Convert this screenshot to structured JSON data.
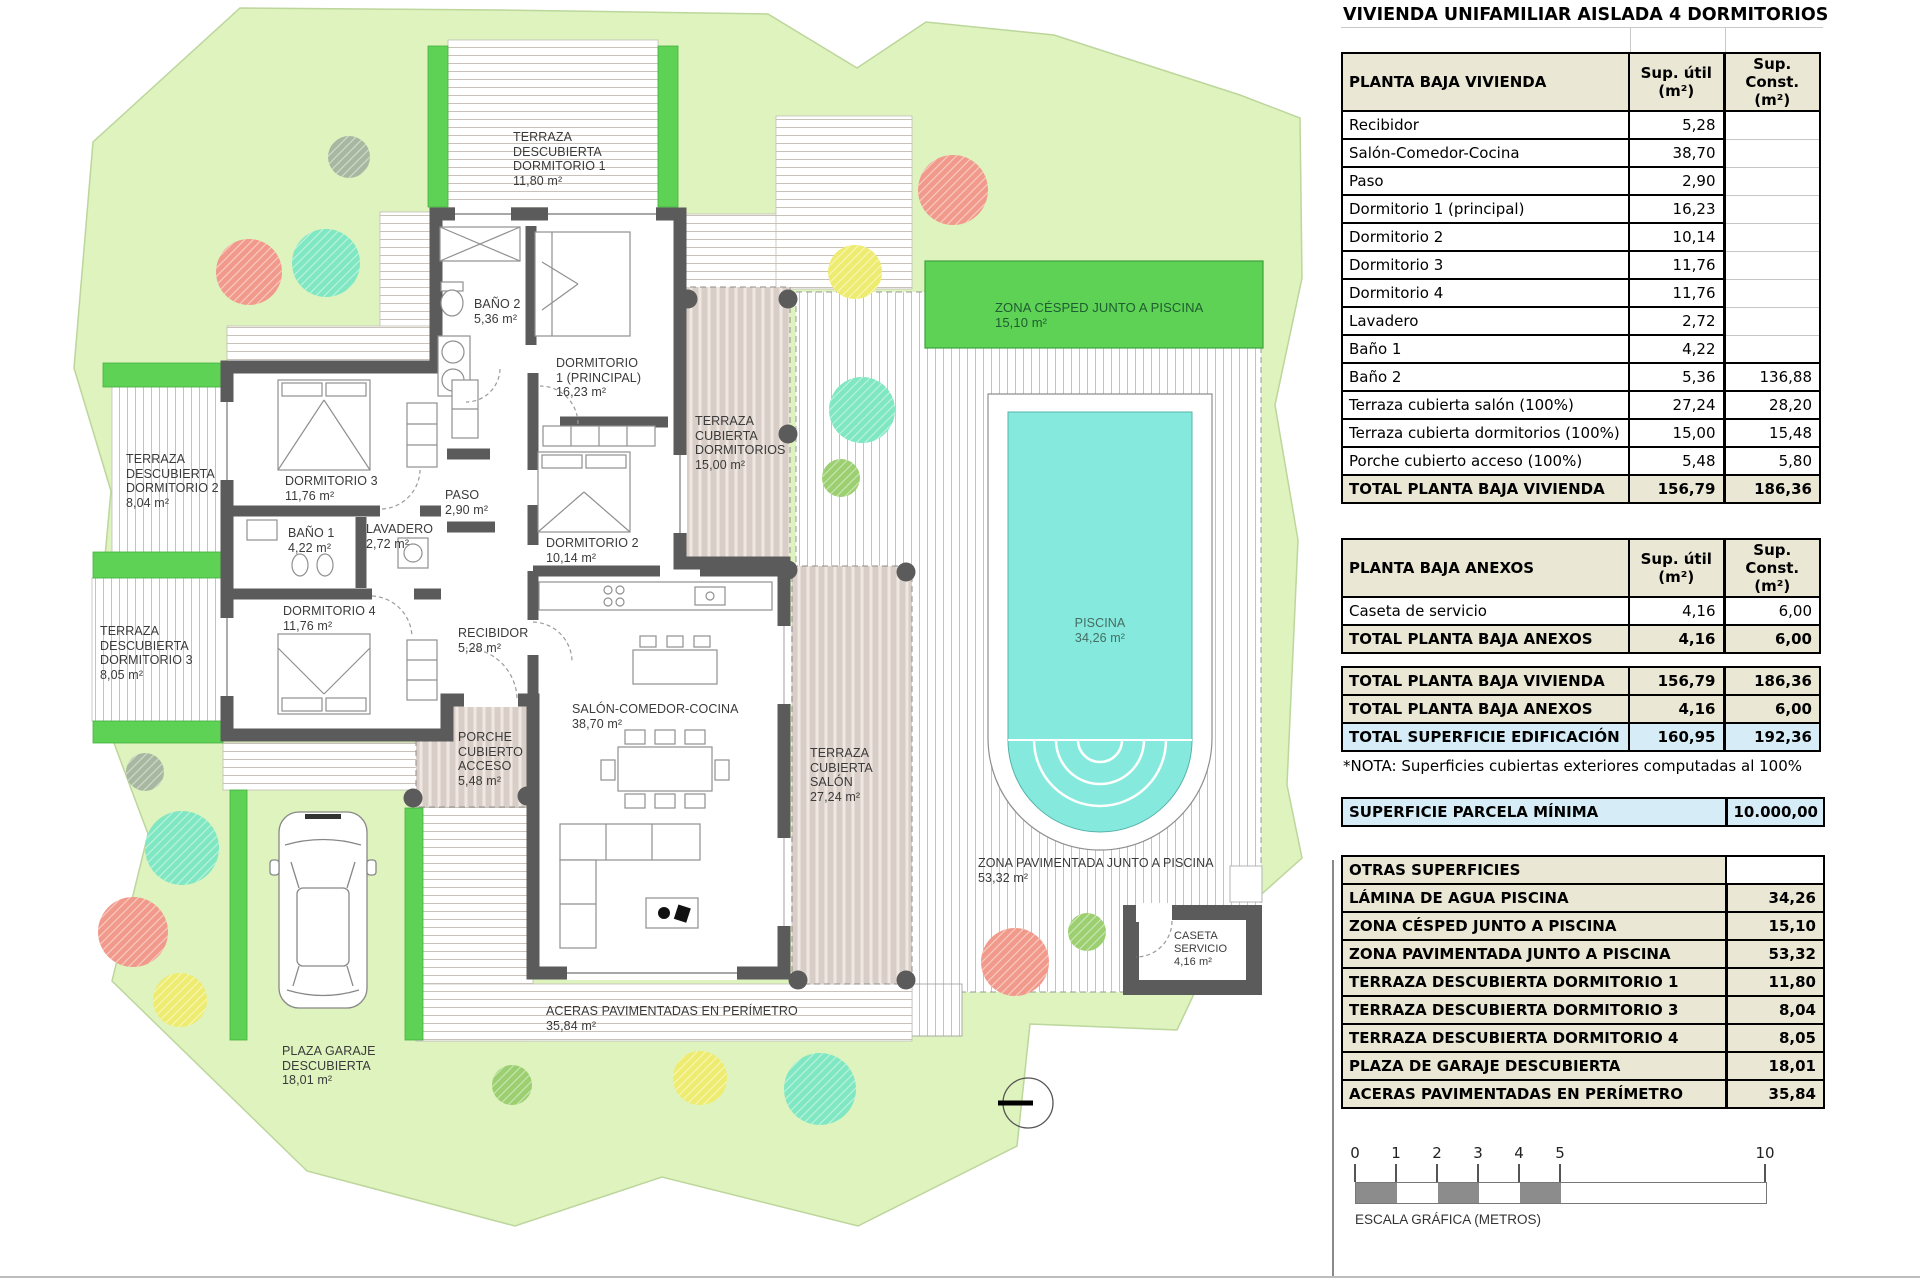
{
  "title": "VIVIENDA UNIFAMILIAR AISLADA 4 DORMITORIOS",
  "tables": {
    "vivienda": {
      "header": {
        "label": "PLANTA BAJA VIVIENDA",
        "col1": "Sup. útil\n(m²)",
        "col2": "Sup. Const.\n(m²)"
      },
      "rows": [
        {
          "label": "Recibidor",
          "util": "5,28",
          "const": ""
        },
        {
          "label": "Salón-Comedor-Cocina",
          "util": "38,70",
          "const": ""
        },
        {
          "label": "Paso",
          "util": "2,90",
          "const": ""
        },
        {
          "label": "Dormitorio 1 (principal)",
          "util": "16,23",
          "const": ""
        },
        {
          "label": "Dormitorio 2",
          "util": "10,14",
          "const": ""
        },
        {
          "label": "Dormitorio 3",
          "util": "11,76",
          "const": ""
        },
        {
          "label": "Dormitorio 4",
          "util": "11,76",
          "const": ""
        },
        {
          "label": "Lavadero",
          "util": "2,72",
          "const": ""
        },
        {
          "label": "Baño 1",
          "util": "4,22",
          "const": ""
        },
        {
          "label": "Baño 2",
          "util": "5,36",
          "const": "136,88"
        },
        {
          "label": "Terraza cubierta salón (100%)",
          "util": "27,24",
          "const": "28,20"
        },
        {
          "label": "Terraza cubierta dormitorios (100%)",
          "util": "15,00",
          "const": "15,48"
        },
        {
          "label": "Porche cubierto acceso (100%)",
          "util": "5,48",
          "const": "5,80"
        }
      ],
      "total": {
        "label": "TOTAL PLANTA BAJA VIVIENDA",
        "util": "156,79",
        "const": "186,36"
      }
    },
    "anexos": {
      "header": {
        "label": "PLANTA BAJA ANEXOS",
        "col1": "Sup. útil\n(m²)",
        "col2": "Sup. Const.\n(m²)"
      },
      "rows": [
        {
          "label": "Caseta de servicio",
          "util": "4,16",
          "const": "6,00"
        }
      ],
      "total": {
        "label": "TOTAL PLANTA BAJA ANEXOS",
        "util": "4,16",
        "const": "6,00"
      }
    },
    "resumen": {
      "rows": [
        {
          "label": "TOTAL PLANTA BAJA VIVIENDA",
          "util": "156,79",
          "const": "186,36"
        },
        {
          "label": "TOTAL PLANTA BAJA ANEXOS",
          "util": "4,16",
          "const": "6,00"
        },
        {
          "label": "TOTAL SUPERFICIE EDIFICACIÓN",
          "util": "160,95",
          "const": "192,36"
        }
      ],
      "nota": "*NOTA: Superficies cubiertas exteriores computadas al 100%"
    },
    "parcela": {
      "label": "SUPERFICIE PARCELA MÍNIMA",
      "value": "10.000,00"
    },
    "otras": {
      "header": "OTRAS SUPERFICIES",
      "rows": [
        {
          "label": "LÁMINA DE AGUA PISCINA",
          "value": "34,26"
        },
        {
          "label": "ZONA CÉSPED JUNTO A PISCINA",
          "value": "15,10"
        },
        {
          "label": "ZONA PAVIMENTADA JUNTO A PISCINA",
          "value": "53,32"
        },
        {
          "label": "TERRAZA DESCUBIERTA DORMITORIO 1",
          "value": "11,80"
        },
        {
          "label": "TERRAZA DESCUBIERTA DORMITORIO 3",
          "value": "8,04"
        },
        {
          "label": "TERRAZA DESCUBIERTA DORMITORIO 4",
          "value": "8,05"
        },
        {
          "label": "PLAZA DE GARAJE DESCUBIERTA",
          "value": "18,01"
        },
        {
          "label": "ACERAS PAVIMENTADAS EN PERÍMETRO",
          "value": "35,84"
        }
      ]
    }
  },
  "scalebar": {
    "ticks": [
      "0",
      "1",
      "2",
      "3",
      "4",
      "5",
      "10"
    ],
    "label": "ESCALA GRÁFICA (METROS)"
  },
  "plan": {
    "labels": {
      "terraza_dorm1": "TERRAZA\nDESCUBIERTA\nDORMITORIO 1\n11,80 m²",
      "bano2": "BAÑO 2\n5,36 m²",
      "dorm1": "DORMITORIO\n1 (PRINCIPAL)\n16,23 m²",
      "terraza_cub_dorms": "TERRAZA\nCUBIERTA\nDORMITORIOS\n15,00 m²",
      "cesped": "ZONA CÉSPED JUNTO A PISCINA\n15,10 m²",
      "terraza_dorm2": "TERRAZA\nDESCUBIERTA\nDORMITORIO 2\n8,04 m²",
      "dorm3": "DORMITORIO 3\n11,76 m²",
      "paso": "PASO\n2,90 m²",
      "bano1": "BAÑO 1\n4,22 m²",
      "lavadero": "LAVADERO\n2,72 m²",
      "dorm2": "DORMITORIO 2\n10,14 m²",
      "dorm4": "DORMITORIO 4\n11,76 m²",
      "recibidor": "RECIBIDOR\n5,28 m²",
      "terraza_dorm3": "TERRAZA\nDESCUBIERTA\nDORMITORIO 3\n8,05 m²",
      "salon": "SALÓN-COMEDOR-COCINA\n38,70 m²",
      "porche": "PORCHE\nCUBIERTO\nACCESO\n5,48 m²",
      "terraza_cub_salon": "TERRAZA\nCUBIERTA\nSALÓN\n27,24 m²",
      "piscina": "PISCINA\n34,26 m²",
      "zona_pavimentada": "ZONA PAVIMENTADA JUNTO A PISCINA\n53,32 m²",
      "caseta": "CASETA\nSERVICIO\n4,16 m²",
      "aceras": "ACERAS PAVIMENTADAS EN PERÍMETRO\n35,84 m²",
      "garaje": "PLAZA GARAJE\nDESCUBIERTA\n18,01 m²"
    }
  },
  "colors": {
    "parcel": "#def3bd",
    "hedge": "#5ed254",
    "lawn": "#5ed254",
    "pool_water": "#85e9dd",
    "covered_deck": "#d9cec7",
    "wall": "#5b5b5b",
    "table_header_bg": "#eae7d4",
    "highlight_blue": "#d6edf7",
    "tree_coral": "#f19a8b",
    "tree_mint": "#7fe7c2",
    "tree_yellow": "#eeec70",
    "tree_green": "#9bcf70",
    "tree_olive": "#a7b7a0"
  }
}
